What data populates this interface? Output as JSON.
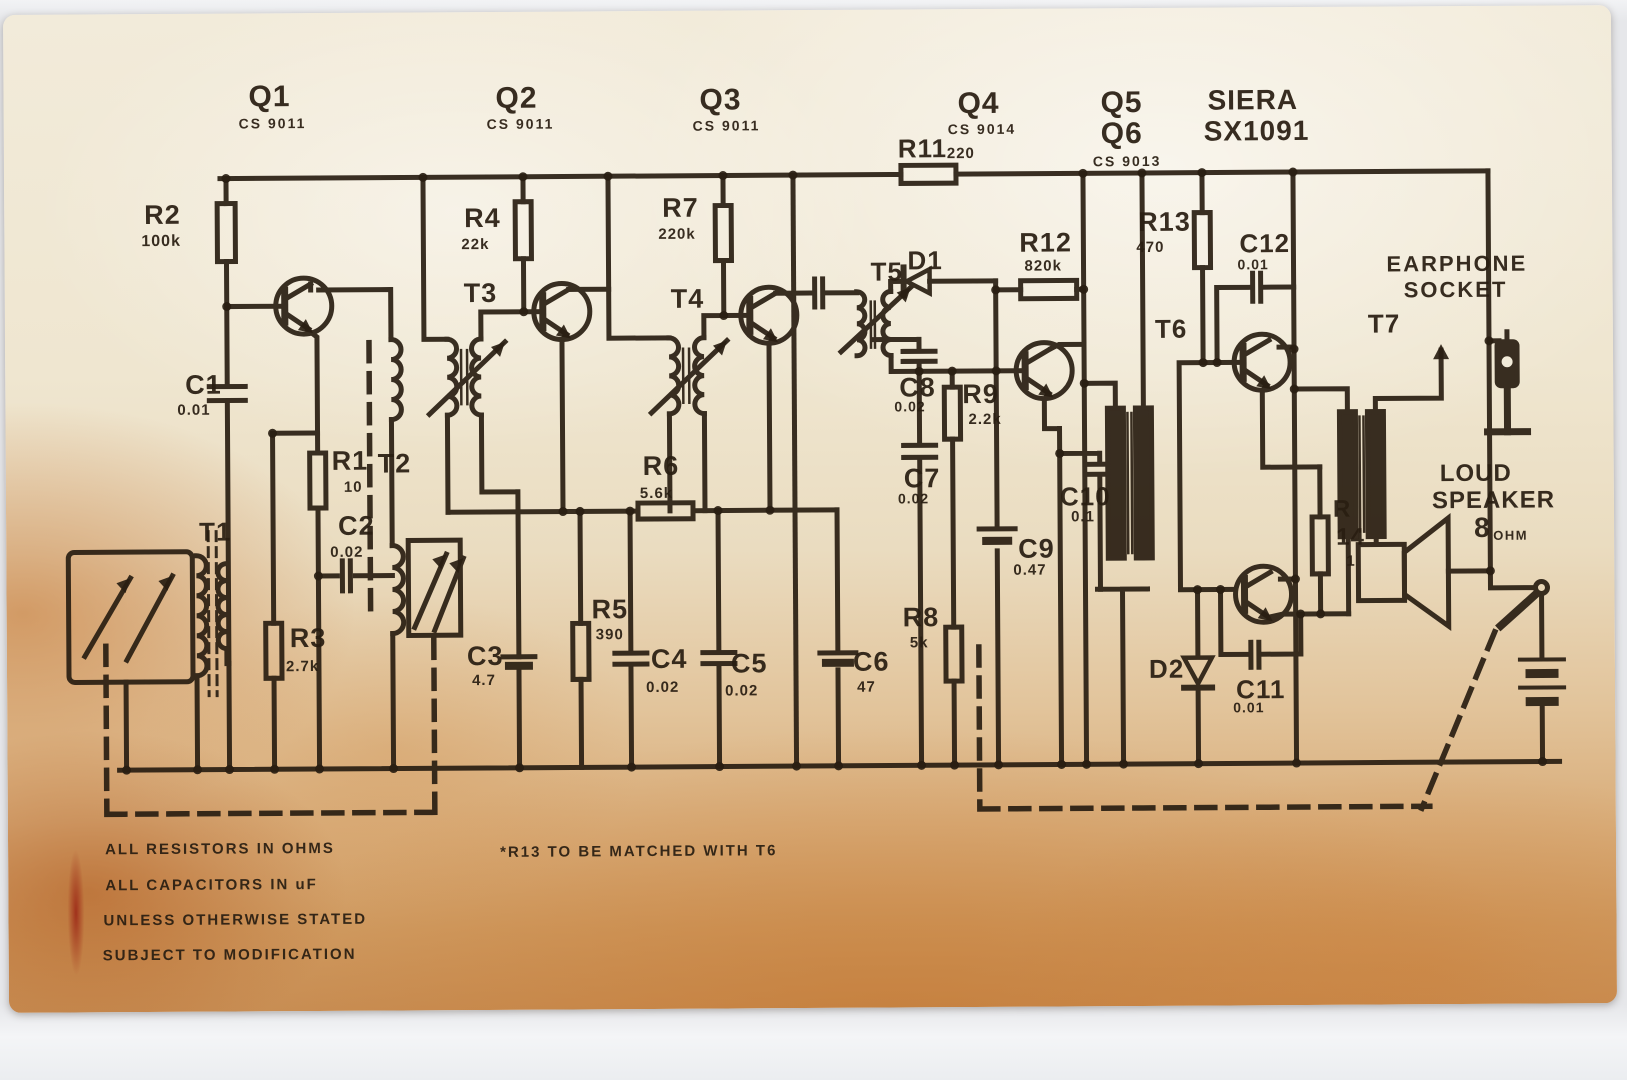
{
  "colors": {
    "background": "#e6e7ea",
    "paper_light": "#f2ebda",
    "paper_aged": "#c88e54",
    "ink": "#291e12"
  },
  "texts": [
    {
      "id": "q1",
      "text": "Q1",
      "x": 251,
      "y": 79,
      "s": 30
    },
    {
      "id": "q1-part",
      "text": "CS 9011",
      "x": 241,
      "y": 113,
      "s": 14,
      "ls": 2
    },
    {
      "id": "q2",
      "text": "Q2",
      "x": 498,
      "y": 82,
      "s": 30
    },
    {
      "id": "q2-part",
      "text": "CS 9011",
      "x": 489,
      "y": 115,
      "s": 14,
      "ls": 2
    },
    {
      "id": "q3",
      "text": "Q3",
      "x": 702,
      "y": 85,
      "s": 30
    },
    {
      "id": "q3-part",
      "text": "CS 9011",
      "x": 695,
      "y": 118,
      "s": 14,
      "ls": 2
    },
    {
      "id": "q4",
      "text": "Q4",
      "x": 960,
      "y": 90,
      "s": 30
    },
    {
      "id": "q4-part",
      "text": "CS 9014",
      "x": 950,
      "y": 123,
      "s": 14,
      "ls": 2
    },
    {
      "id": "q5",
      "text": "Q5",
      "x": 1103,
      "y": 90,
      "s": 30
    },
    {
      "id": "q6",
      "text": "Q6",
      "x": 1103,
      "y": 121,
      "s": 30
    },
    {
      "id": "q5q6-part",
      "text": "CS 9013",
      "x": 1095,
      "y": 156,
      "s": 14,
      "ls": 2
    },
    {
      "id": "brand-name",
      "text": "SIERA",
      "x": 1210,
      "y": 89,
      "s": 28
    },
    {
      "id": "brand-model",
      "text": "SX1091",
      "x": 1206,
      "y": 120,
      "s": 28
    },
    {
      "id": "r11",
      "text": "R11",
      "x": 900,
      "y": 136,
      "s": 26
    },
    {
      "id": "r11-value",
      "text": "220",
      "x": 949,
      "y": 147,
      "s": 15
    },
    {
      "id": "r2",
      "text": "R2",
      "x": 146,
      "y": 198,
      "s": 27
    },
    {
      "id": "r2-value",
      "text": "100k",
      "x": 143,
      "y": 230,
      "s": 16
    },
    {
      "id": "c1",
      "text": "C1",
      "x": 186,
      "y": 368,
      "s": 27
    },
    {
      "id": "c1-value",
      "text": "0.01",
      "x": 178,
      "y": 399,
      "s": 15
    },
    {
      "id": "r1",
      "text": "R1",
      "x": 332,
      "y": 445,
      "s": 27
    },
    {
      "id": "t2",
      "text": "T2",
      "x": 378,
      "y": 448,
      "s": 27
    },
    {
      "id": "r1-value",
      "text": "10",
      "x": 344,
      "y": 477,
      "s": 15
    },
    {
      "id": "c2",
      "text": "C2",
      "x": 338,
      "y": 510,
      "s": 27
    },
    {
      "id": "c2-value",
      "text": "0.02",
      "x": 330,
      "y": 542,
      "s": 15
    },
    {
      "id": "t1",
      "text": "T1",
      "x": 199,
      "y": 515,
      "s": 26
    },
    {
      "id": "r3",
      "text": "R3",
      "x": 289,
      "y": 622,
      "s": 27
    },
    {
      "id": "r3-value",
      "text": "2.7k",
      "x": 285,
      "y": 656,
      "s": 15
    },
    {
      "id": "r4",
      "text": "R4",
      "x": 466,
      "y": 203,
      "s": 27
    },
    {
      "id": "r4-value",
      "text": "22k",
      "x": 463,
      "y": 235,
      "s": 15
    },
    {
      "id": "t3",
      "text": "T3",
      "x": 465,
      "y": 278,
      "s": 27
    },
    {
      "id": "r7",
      "text": "R7",
      "x": 664,
      "y": 194,
      "s": 27
    },
    {
      "id": "r7-value",
      "text": "220k",
      "x": 660,
      "y": 226,
      "s": 15
    },
    {
      "id": "t4",
      "text": "T4",
      "x": 672,
      "y": 285,
      "s": 27
    },
    {
      "id": "r6",
      "text": "R6",
      "x": 643,
      "y": 452,
      "s": 27
    },
    {
      "id": "r6-value",
      "text": "5.6k",
      "x": 640,
      "y": 485,
      "s": 15
    },
    {
      "id": "r5",
      "text": "R5",
      "x": 591,
      "y": 595,
      "s": 27
    },
    {
      "id": "r5-value",
      "text": "390",
      "x": 595,
      "y": 626,
      "s": 15
    },
    {
      "id": "c3",
      "text": "C3",
      "x": 466,
      "y": 641,
      "s": 27
    },
    {
      "id": "c3-value",
      "text": "4.7",
      "x": 471,
      "y": 671,
      "s": 15
    },
    {
      "id": "c4",
      "text": "C4",
      "x": 650,
      "y": 645,
      "s": 27
    },
    {
      "id": "c4-value",
      "text": "0.02",
      "x": 645,
      "y": 679,
      "s": 15
    },
    {
      "id": "c5",
      "text": "C5",
      "x": 730,
      "y": 650,
      "s": 27
    },
    {
      "id": "c5-value",
      "text": "0.02",
      "x": 724,
      "y": 683,
      "s": 15
    },
    {
      "id": "c6",
      "text": "C6",
      "x": 852,
      "y": 649,
      "s": 27
    },
    {
      "id": "c6-value",
      "text": "47",
      "x": 856,
      "y": 680,
      "s": 15
    },
    {
      "id": "t5",
      "text": "T5",
      "x": 872,
      "y": 259,
      "s": 26
    },
    {
      "id": "d1",
      "text": "D1",
      "x": 909,
      "y": 248,
      "s": 26
    },
    {
      "id": "c8",
      "text": "C8",
      "x": 900,
      "y": 375,
      "s": 27
    },
    {
      "id": "c8-value",
      "text": "0.02",
      "x": 895,
      "y": 400,
      "s": 14
    },
    {
      "id": "r9",
      "text": "R9",
      "x": 963,
      "y": 382,
      "s": 27
    },
    {
      "id": "r9-value",
      "text": "2.2k",
      "x": 969,
      "y": 413,
      "s": 15
    },
    {
      "id": "c7",
      "text": "C7",
      "x": 904,
      "y": 466,
      "s": 27
    },
    {
      "id": "c7-value",
      "text": "0.02",
      "x": 898,
      "y": 492,
      "s": 14
    },
    {
      "id": "r8",
      "text": "R8",
      "x": 902,
      "y": 605,
      "s": 27
    },
    {
      "id": "r8-value",
      "text": "5k",
      "x": 909,
      "y": 636,
      "s": 15
    },
    {
      "id": "c9",
      "text": "C9",
      "x": 1018,
      "y": 537,
      "s": 27
    },
    {
      "id": "c9-value",
      "text": "0.47",
      "x": 1013,
      "y": 564,
      "s": 15
    },
    {
      "id": "c10",
      "text": "C10",
      "x": 1060,
      "y": 485,
      "s": 26
    },
    {
      "id": "c10-value",
      "text": "0.1",
      "x": 1071,
      "y": 511,
      "s": 15
    },
    {
      "id": "r12",
      "text": "R12",
      "x": 1021,
      "y": 231,
      "s": 27
    },
    {
      "id": "r12-value",
      "text": "820k",
      "x": 1026,
      "y": 260,
      "s": 15
    },
    {
      "id": "r13",
      "text": "R13",
      "x": 1140,
      "y": 211,
      "s": 27
    },
    {
      "id": "r13-value",
      "text": "470",
      "x": 1138,
      "y": 242,
      "s": 15
    },
    {
      "id": "c12",
      "text": "C12",
      "x": 1241,
      "y": 233,
      "s": 26
    },
    {
      "id": "c12-value",
      "text": "0.01",
      "x": 1239,
      "y": 260,
      "s": 14
    },
    {
      "id": "t6",
      "text": "T6",
      "x": 1156,
      "y": 318,
      "s": 26
    },
    {
      "id": "t7",
      "text": "T7",
      "x": 1369,
      "y": 314,
      "s": 26
    },
    {
      "id": "d2",
      "text": "D2",
      "x": 1148,
      "y": 658,
      "s": 26
    },
    {
      "id": "c11",
      "text": "C11",
      "x": 1235,
      "y": 679,
      "s": 26
    },
    {
      "id": "c11-value",
      "text": "0.01",
      "x": 1232,
      "y": 703,
      "s": 14
    },
    {
      "id": "r14-ref",
      "text": "R",
      "x": 1333,
      "y": 501,
      "s": 24
    },
    {
      "id": "r14-num",
      "text": "14",
      "x": 1336,
      "y": 529,
      "s": 24
    },
    {
      "id": "r14-value",
      "text": "1",
      "x": 1346,
      "y": 557,
      "s": 15
    },
    {
      "id": "earphone-line1",
      "text": "EARPHONE",
      "x": 1388,
      "y": 257,
      "s": 22,
      "ls": 2
    },
    {
      "id": "earphone-line2",
      "text": "SOCKET",
      "x": 1405,
      "y": 283,
      "s": 22,
      "ls": 2
    },
    {
      "id": "loudspeaker-line1",
      "text": "LOUD",
      "x": 1440,
      "y": 466,
      "s": 24
    },
    {
      "id": "loudspeaker-line2",
      "text": "SPEAKER",
      "x": 1432,
      "y": 493,
      "s": 24
    },
    {
      "id": "speaker-impedance",
      "text": "8",
      "x": 1474,
      "y": 518,
      "s": 28
    },
    {
      "id": "speaker-impedance-unit",
      "text": "OHM",
      "x": 1493,
      "y": 533,
      "s": 13,
      "ls": 1.5
    },
    {
      "id": "note-1",
      "text": "ALL RESISTORS IN OHMS",
      "x": 103,
      "y": 838,
      "s": 15,
      "ls": 2
    },
    {
      "id": "note-2",
      "text": "ALL CAPACITORS IN uF",
      "x": 103,
      "y": 874,
      "s": 15,
      "ls": 2
    },
    {
      "id": "note-3",
      "text": "UNLESS OTHERWISE STATED",
      "x": 101,
      "y": 909,
      "s": 15,
      "ls": 2
    },
    {
      "id": "note-4",
      "text": "SUBJECT TO MODIFICATION",
      "x": 100,
      "y": 944,
      "s": 15,
      "ls": 2
    },
    {
      "id": "note-r13",
      "text": "*R13 TO BE MATCHED WITH T6",
      "x": 498,
      "y": 843,
      "s": 15,
      "ls": 2
    }
  ]
}
